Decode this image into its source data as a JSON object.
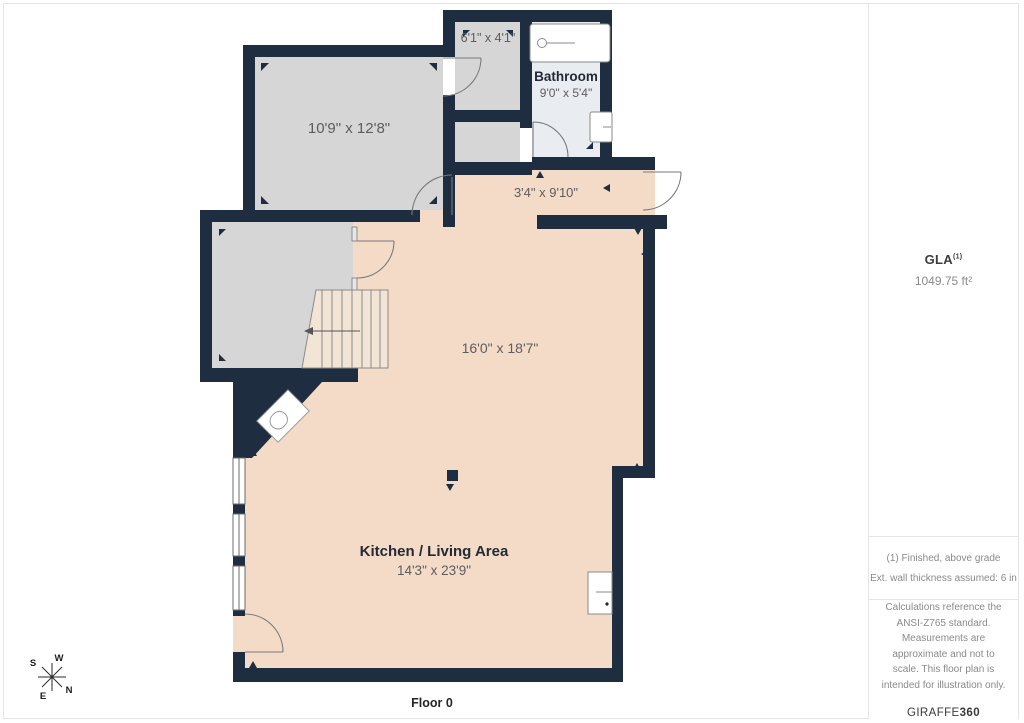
{
  "plan": {
    "rooms": {
      "room1": {
        "dims": "10'9\" x 12'8\""
      },
      "room2": {
        "dims": "6'1\" x 4'1\""
      },
      "bathroom": {
        "name": "Bathroom",
        "dims": "9'0\" x 5'4\""
      },
      "hallway": {
        "dims": "3'4\" x 9'10\""
      },
      "upper_area": {
        "dims": "16'0\" x 18'7\""
      },
      "kitchen_living": {
        "name": "Kitchen / Living Area",
        "dims": "14'3\" x 23'9\""
      }
    },
    "compass": {
      "n": "N",
      "s": "S",
      "e": "E",
      "w": "W"
    },
    "floor_label": "Floor 0",
    "colors": {
      "wall": "#1e2e40",
      "floor": "#f4dbc8",
      "room_gray": "#d6d6d6",
      "bathroom": "#e9ecf1",
      "stairs": "#f3e5d6",
      "fixture_line": "#8a8a8a",
      "dim_text": "#5d5d5d",
      "name_text": "#222b35"
    }
  },
  "sidebar": {
    "gla": {
      "label": "GLA",
      "superscript": "(1)",
      "value": "1049.75 ft²"
    },
    "notes": {
      "note1": "(1) Finished, above grade",
      "note2": "Ext. wall thickness assumed: 6 in"
    },
    "disclaimer": "Calculations reference the ANSI-Z765 standard. Measurements are approximate and not to scale. This floor plan is intended for illustration only.",
    "logo": {
      "regular": "GIRAFFE",
      "bold": "360"
    }
  }
}
